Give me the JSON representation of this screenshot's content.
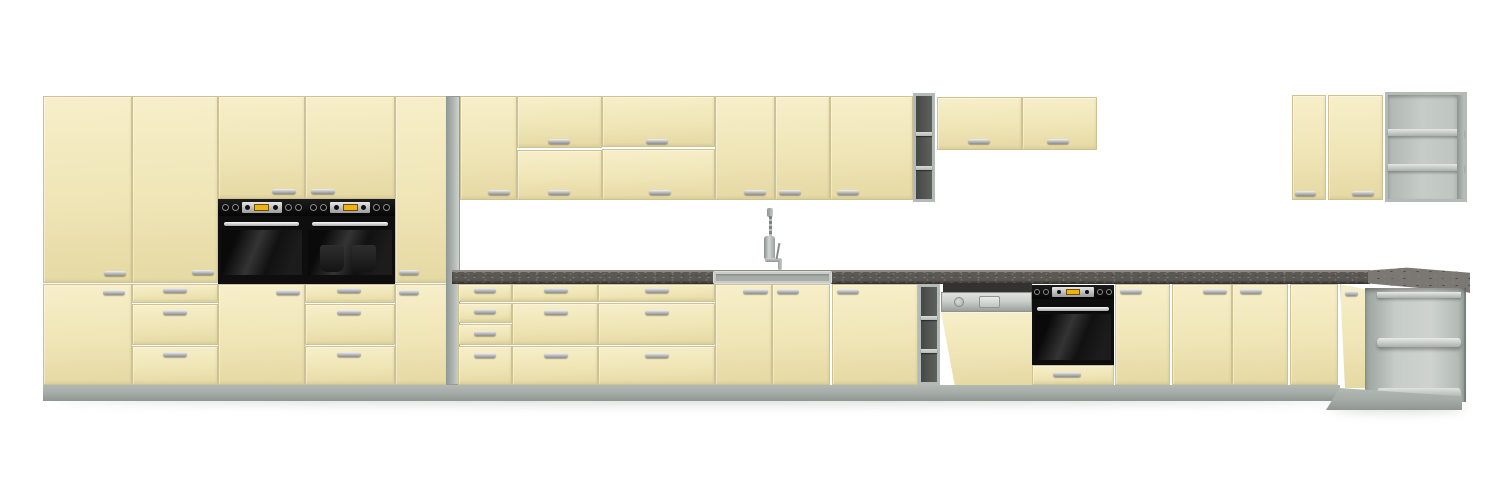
{
  "scene": {
    "description": "3D product render of a cream (vanilla) modular kitchen cabinet set on a white background: tall larder run with two built-in double ovens on the left, a long wall-cabinet run and base run with sink, semi-integrated dishwasher and single built-in oven in the middle, open gray shelf columns, and an angled open-shelf corner unit with wall cabinets on the far right.",
    "visible_text": ""
  },
  "colors": {
    "background": "#ffffff",
    "cream": "#efe5b6",
    "cream_light": "#f7efca",
    "cream_dark": "#e5d9a3",
    "cream_edge": "#cec193",
    "panel_gray": "#b4bbb7",
    "panel_dark": "#949b97",
    "panel_light": "#cdd3cf",
    "cavity_dark": "#50534f",
    "interior_light": "#c6ccc8",
    "plinth": "#a4aba6",
    "plinth_light": "#b2b9b4",
    "plinth_dark": "#8f968f",
    "counter": "#5b5752",
    "counter_speckle": "#7f7b76",
    "counter_edge": "#8d8a86",
    "counter_surface": "#7b7772",
    "steel": "#ccd0cc",
    "steel_dark": "#9ba09d",
    "display_amber": "#eeb211",
    "handle_light": "#f2f2f2",
    "handle_dark": "#8c8c8c",
    "glass_sheen": "#343434",
    "shadow": "rgba(90,95,90,0.22)"
  },
  "inventory": {
    "tall_cabinets": [
      "larder-two-door",
      "larder-door-with-three-drawers",
      "oven-housing-left",
      "oven-housing-right",
      "slim-larder-two-door",
      "gray-end-panel"
    ],
    "wall_cabinets": [
      "single-door",
      "two-flap-door",
      "two-flap-door-wide",
      "single-door",
      "single-door",
      "single-door-wide",
      "open-shelf-column",
      "short-single-door",
      "short-single-door",
      "corner-door",
      "corner-door-wide",
      "corner-open-shelf-unit"
    ],
    "base_cabinets": [
      "four-drawer-unit",
      "three-drawer-unit",
      "three-drawer-unit-wide",
      "sink-door-left",
      "sink-door-right",
      "single-door-wide",
      "open-shelf-column",
      "dishwasher-housing",
      "oven-housing-with-drawer",
      "single-door",
      "single-door",
      "single-door",
      "blind-corner-door",
      "angled-corner-door",
      "open-corner-shelf-unit"
    ],
    "appliances": [
      "built-in-double-oven-left",
      "built-in-double-oven-right",
      "semi-integrated-dishwasher",
      "built-in-single-oven",
      "inset-sink",
      "mixer-tap"
    ],
    "counts": {
      "handles": 40,
      "open_shelf_compartments": 9,
      "ovens": 3
    }
  }
}
